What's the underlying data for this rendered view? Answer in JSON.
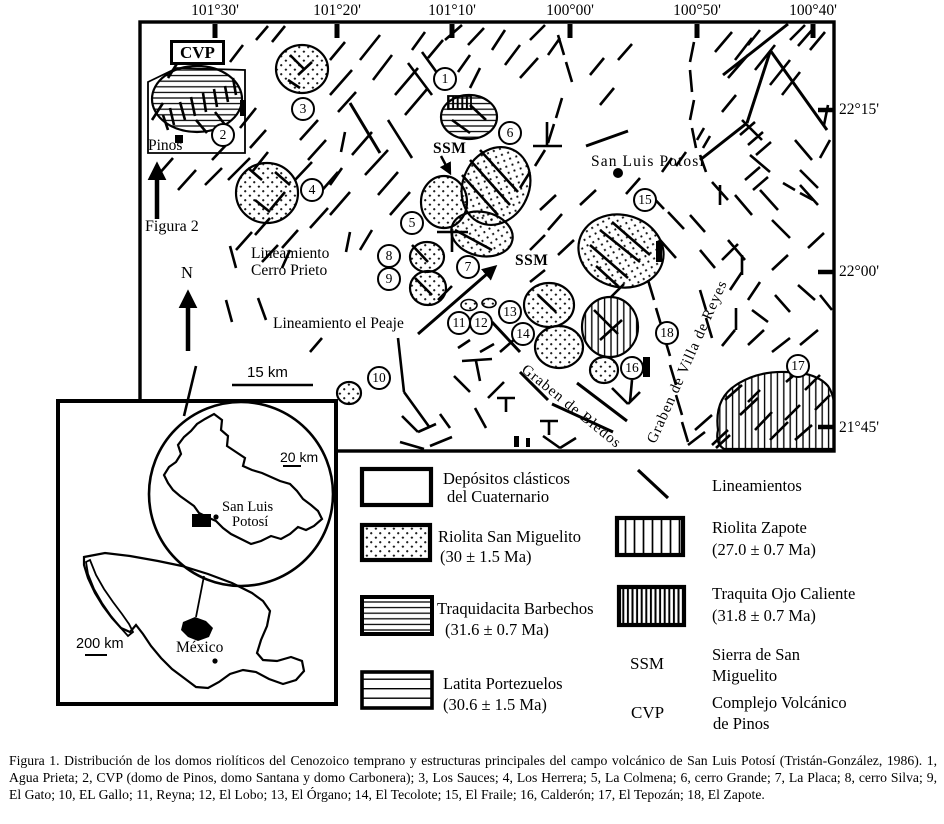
{
  "axis": {
    "top": [
      "101°30'",
      "101°20'",
      "101°10'",
      "100°00'",
      "100°50'",
      "100°40'"
    ],
    "right": [
      "22°15'",
      "22°00'",
      "21°45'"
    ]
  },
  "map": {
    "cvp_box": "CVP",
    "pinos": "Pinos",
    "figura2": "Figura 2",
    "north": "N",
    "lineamiento_cp_line1": "Lineamiento",
    "lineamiento_cp_line2": "Cerro Prieto",
    "lineamiento_peaje": "Lineamiento el Peaje",
    "scale_bar": "15 km",
    "ssm_label_1": "SSM",
    "ssm_label_2": "SSM",
    "city": "San Luis Potosi",
    "graben_bledos": "Graben de Bledos",
    "graben_villa_reyes": "Graben de Villa de Reyes"
  },
  "markers": [
    {
      "n": "1",
      "x": 445,
      "y": 79
    },
    {
      "n": "2",
      "x": 223,
      "y": 135
    },
    {
      "n": "3",
      "x": 303,
      "y": 109
    },
    {
      "n": "4",
      "x": 312,
      "y": 190
    },
    {
      "n": "5",
      "x": 412,
      "y": 223
    },
    {
      "n": "6",
      "x": 510,
      "y": 133
    },
    {
      "n": "7",
      "x": 468,
      "y": 267
    },
    {
      "n": "8",
      "x": 389,
      "y": 256
    },
    {
      "n": "9",
      "x": 389,
      "y": 279
    },
    {
      "n": "10",
      "x": 379,
      "y": 378
    },
    {
      "n": "11",
      "x": 459,
      "y": 323
    },
    {
      "n": "12",
      "x": 481,
      "y": 323
    },
    {
      "n": "13",
      "x": 510,
      "y": 312
    },
    {
      "n": "14",
      "x": 523,
      "y": 334
    },
    {
      "n": "15",
      "x": 645,
      "y": 200
    },
    {
      "n": "16",
      "x": 632,
      "y": 368
    },
    {
      "n": "17",
      "x": 798,
      "y": 366
    },
    {
      "n": "18",
      "x": 667,
      "y": 333
    }
  ],
  "inset": {
    "scale_upper": "20 km",
    "scale_lower": "200 km",
    "city_line1": "San Luis",
    "city_line2": "Potosí",
    "country": "México"
  },
  "legend": {
    "items_left": [
      {
        "name": "depositos-clasticos",
        "pattern": "blank",
        "line1": "Depósitos clásticos",
        "line2": "del Cuaternario"
      },
      {
        "name": "riolita-san-miguelito",
        "pattern": "dots",
        "line1": "Riolita San Miguelito",
        "line2": "(30 ± 1.5 Ma)"
      },
      {
        "name": "traquidacita-barbechos",
        "pattern": "hlines-dense",
        "line1": "Traquidacita Barbechos",
        "line2": "(31.6 ± 0.7 Ma)"
      },
      {
        "name": "latita-portezuelos",
        "pattern": "hlines-sparse",
        "line1": "Latita Portezuelos",
        "line2": "(30.6 ± 1.5 Ma)"
      }
    ],
    "items_right": [
      {
        "name": "lineamientos",
        "symbol": "diagonal-line",
        "line1": "Lineamientos",
        "line2": ""
      },
      {
        "name": "riolita-zapote",
        "pattern": "vlines-sparse",
        "line1": "Riolita Zapote",
        "line2": "(27.0 ± 0.7 Ma)"
      },
      {
        "name": "traquita-ojo-caliente",
        "pattern": "vlines-dense",
        "line1": "Traquita Ojo Caliente",
        "line2": "(31.8 ± 0.7 Ma)"
      },
      {
        "name": "ssm-abbr",
        "abbr": "SSM",
        "line1": "Sierra de San",
        "line2": "Miguelito"
      },
      {
        "name": "cvp-abbr",
        "abbr": "CVP",
        "line1": "Complejo Volcánico",
        "line2": "de Pinos"
      }
    ]
  },
  "caption": "Figura 1. Distribución de los domos riolíticos del Cenozoico temprano y estructuras principales del campo volcánico de San Luis Potosí (Tristán-González, 1986). 1, Agua Prieta; 2, CVP (domo de Pinos, domo Santana y domo Carbonera); 3, Los Sauces; 4, Los Herrera; 5, La Colmena; 6, cerro Grande; 7, La Placa; 8, cerro Silva; 9, El Gato; 10, EL Gallo; 11, Reyna; 12, El Lobo; 13, El Órgano; 14, El Tecolote; 15, El Fraile; 16, Calderón; 17, El Tepozán; 18, El Zapote."
}
